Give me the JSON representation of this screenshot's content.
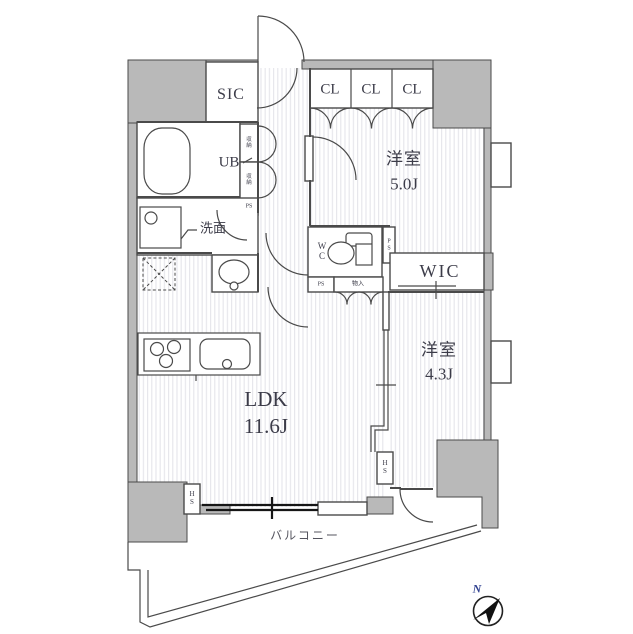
{
  "plan": {
    "rooms": {
      "sic": "SIC",
      "closets": [
        "CL",
        "CL",
        "CL"
      ],
      "bedroom1": {
        "name": "洋室",
        "size": "5.0J"
      },
      "bedroom2": {
        "name": "洋室",
        "size": "4.3J"
      },
      "ldk": {
        "name": "LDK",
        "size": "11.6J"
      },
      "ub": "UB",
      "washroom": "洗面",
      "wc": "W\nC",
      "wic": "WIC",
      "balcony": "バルコニー"
    },
    "labels": {
      "ps_hall": "PS",
      "ps_wc": "P\nS",
      "ps_ldk": "PS",
      "hs_left": "H\nS",
      "hs_right": "H\nS",
      "storage_top": "収\n納",
      "storage_bottom": "収\n納",
      "cupboard": "物入"
    },
    "compass": {
      "north": "N"
    }
  },
  "colors": {
    "wall": "#b9b9b9",
    "line": "#4a4a4a",
    "window": "#161616",
    "stripe": "#e5e5ea",
    "text": "#3c3c49",
    "north": "#2d3f8f"
  }
}
